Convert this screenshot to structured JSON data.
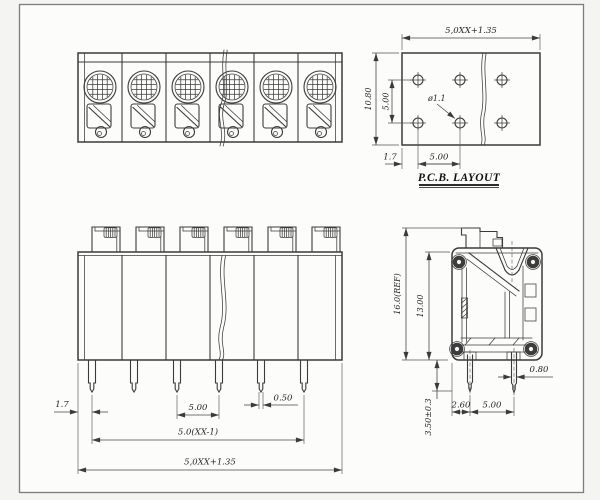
{
  "views": {
    "top_view": {
      "positions": 6
    },
    "pcb_layout": {
      "title": "P.C.B. LAYOUT",
      "hole_count": 6,
      "dims": {
        "overall_width": "5,0XX+1.35",
        "overall_height": "10.80",
        "row_pitch": "5.00",
        "hole_diameter": "ø1.1",
        "edge_offset": "1.7",
        "col_pitch": "5.00"
      }
    },
    "front_view": {
      "positions": 6,
      "dims": {
        "edge_offset": "1.7",
        "pin_pitch": "5.00",
        "pin_width": "0.50",
        "pin_span": "5.0(XX-1)",
        "overall_width": "5,0XX+1.35"
      }
    },
    "side_view": {
      "dims": {
        "overall_height": "16.0(REF)",
        "body_height": "13.00",
        "pin_thickness": "0.80",
        "edge_to_pin": "2.60",
        "pin_pitch": "5.00",
        "pin_length": "3.50±0.3"
      }
    }
  },
  "colors": {
    "line": "#3b3b3b",
    "background": "#f4f4f2",
    "paper": "#fcfcfa"
  }
}
